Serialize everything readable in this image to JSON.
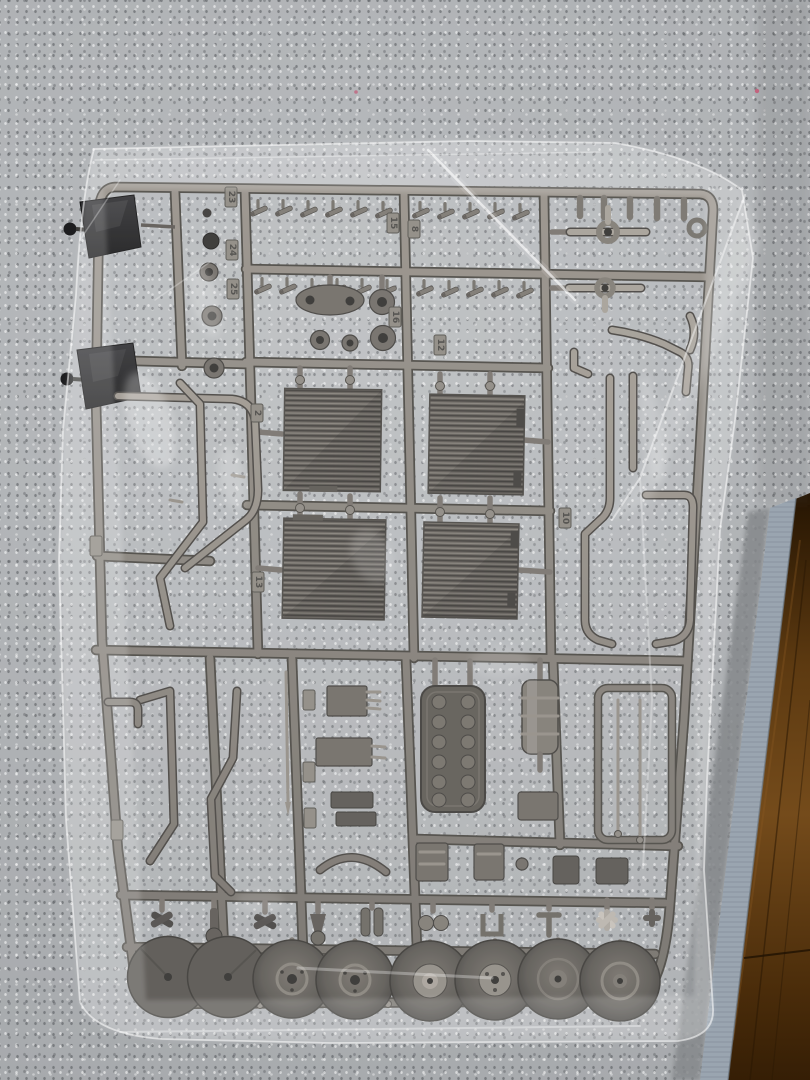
{
  "scene": {
    "subject": "Silver-gray plastic model-kit sprue sealed in a clear plastic bag, lying on a gray speckled carpet next to a dark hardwood floor",
    "colors": {
      "carpet": "#b2b5b8",
      "rug_binding": "#9aa5b0",
      "wood_floor": "#5d3a11",
      "wood_floor_dark": "#241402",
      "sprue_metal": "#7b766f",
      "sprue_metal_dark": "#45423d",
      "sprue_metal_light": "#a19b93",
      "mirror_part": "#212123",
      "bag_highlight": "#ffffff",
      "pink_fleck": "#c2637e"
    }
  },
  "sprue": {
    "material": "silver-gray molded plastic runner",
    "part_tags": [
      {
        "label": "23"
      },
      {
        "label": "24"
      },
      {
        "label": "25"
      },
      {
        "label": "15"
      },
      {
        "label": "8"
      },
      {
        "label": "16"
      },
      {
        "label": "12"
      },
      {
        "label": "2"
      },
      {
        "label": "13"
      },
      {
        "label": "10"
      }
    ],
    "counts": {
      "wheel_discs": 8,
      "grille_panels": 4,
      "mirror_parts": 2,
      "bolt_parts": 22
    }
  }
}
